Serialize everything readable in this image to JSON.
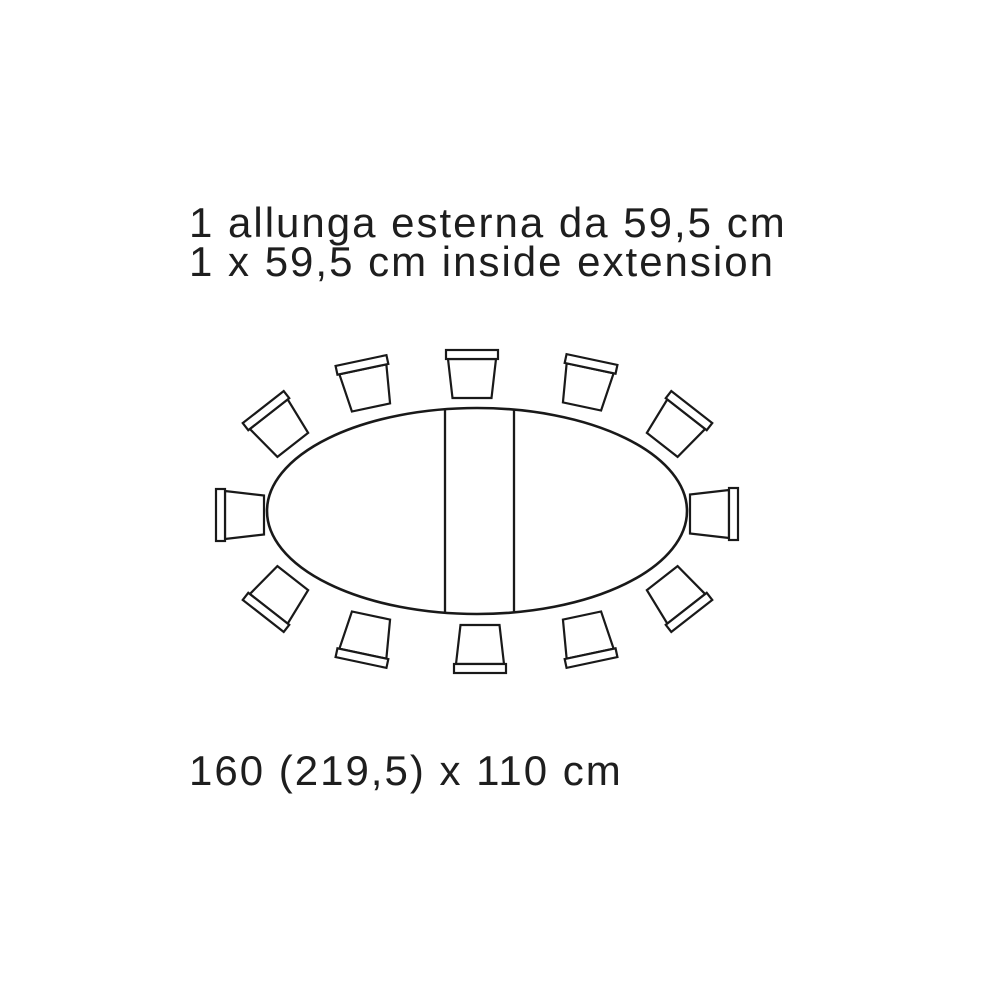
{
  "caption": {
    "line1_it": "1 allunga esterna da 59,5 cm",
    "line2_en": "1 x 59,5 cm inside extension"
  },
  "dimensions_label": "160 (219,5) x 110 cm",
  "colors": {
    "background": "#ffffff",
    "line": "#191919",
    "text": "#1e1e1e",
    "fill": "#ffffff"
  },
  "diagram": {
    "type": "table-top-view-plan",
    "seat_count": 12,
    "table": {
      "shape": "oval",
      "cx": 477,
      "cy": 511,
      "rx": 210,
      "ry": 103,
      "outline_stroke_width": 2.6,
      "extension_leaf": {
        "x_left": 445,
        "x_right": 514,
        "y_top": 409,
        "y_bottom": 613,
        "stroke_width": 2.3
      }
    },
    "chair_shape": {
      "backrest": {
        "x": -26,
        "y": -24,
        "width": 52,
        "height": 9
      },
      "seat_points": "-24,-15 24,-15 19.5,24 -19.5,24",
      "stroke_width": 2.2
    },
    "chairs": [
      {
        "x": 472,
        "y": 374,
        "angle": 0
      },
      {
        "x": 587,
        "y": 383,
        "angle": 12
      },
      {
        "x": 677,
        "y": 426,
        "angle": 38
      },
      {
        "x": 714,
        "y": 514,
        "angle": 90
      },
      {
        "x": 677,
        "y": 597,
        "angle": 142
      },
      {
        "x": 587,
        "y": 639,
        "angle": 168
      },
      {
        "x": 480,
        "y": 649,
        "angle": 180
      },
      {
        "x": 366,
        "y": 639,
        "angle": -168
      },
      {
        "x": 278,
        "y": 597,
        "angle": -142
      },
      {
        "x": 240,
        "y": 515,
        "angle": -90
      },
      {
        "x": 278,
        "y": 426,
        "angle": -38
      },
      {
        "x": 366,
        "y": 384,
        "angle": -12
      }
    ]
  }
}
